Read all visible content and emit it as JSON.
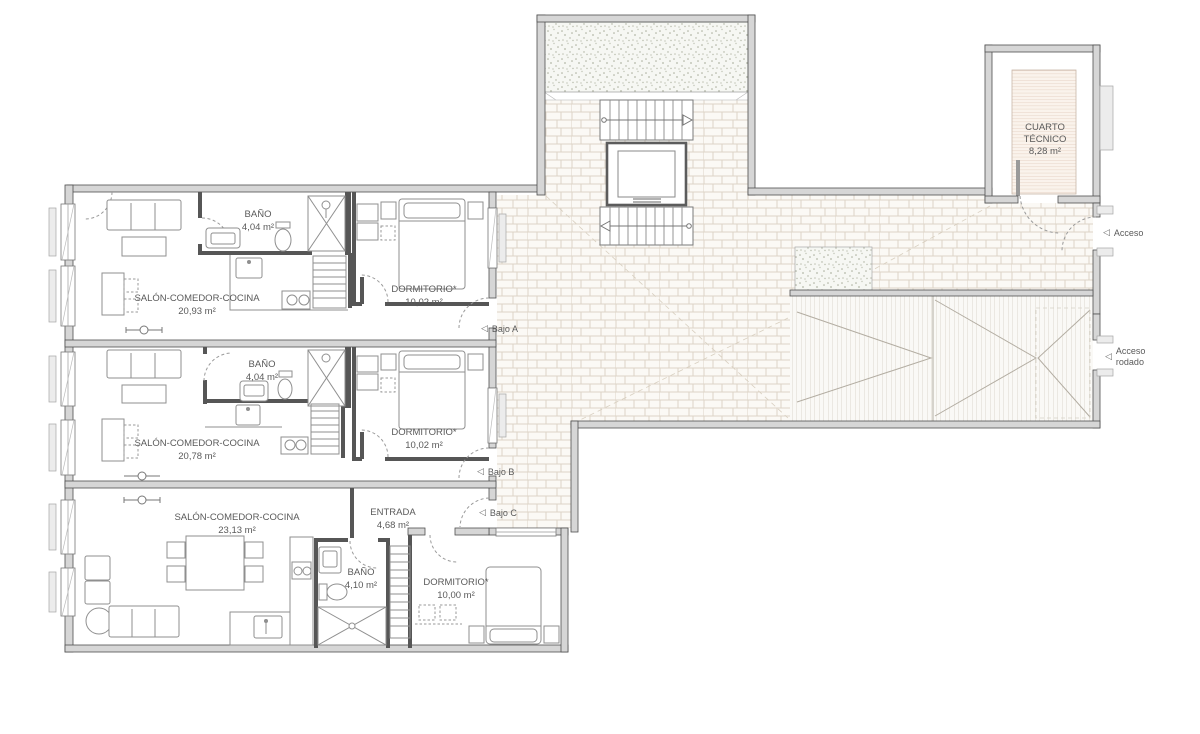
{
  "rooms": {
    "salon_a": {
      "name": "SALÓN-COMEDOR-COCINA",
      "area": "20,93 m²"
    },
    "bano_a": {
      "name": "BAÑO",
      "area": "4,04 m²"
    },
    "dorm_a": {
      "name": "DORMITORIO*",
      "area": "10,02 m²"
    },
    "salon_b": {
      "name": "SALÓN-COMEDOR-COCINA",
      "area": "20,78 m²"
    },
    "bano_b": {
      "name": "BAÑO",
      "area": "4,04 m²"
    },
    "dorm_b": {
      "name": "DORMITORIO*",
      "area": "10,02 m²"
    },
    "salon_c": {
      "name": "SALÓN-COMEDOR-COCINA",
      "area": "23,13 m²"
    },
    "entrada_c": {
      "name": "ENTRADA",
      "area": "4,68 m²"
    },
    "bano_c": {
      "name": "BAÑO",
      "area": "4,10 m²"
    },
    "dorm_c": {
      "name": "DORMITORIO*",
      "area": "10,00 m²"
    },
    "cuarto_tecnico": {
      "name_line1": "CUARTO",
      "name_line2": "TÉCNICO",
      "area": "8,28 m²"
    }
  },
  "annotations": {
    "bajo_a": "Bajo A",
    "bajo_b": "Bajo B",
    "bajo_c": "Bajo C",
    "acceso": "Acceso",
    "acceso_rodado_line1": "Acceso",
    "acceso_rodado_line2": "rodado"
  },
  "icons": {
    "direction_triangle": "◁"
  },
  "colors": {
    "wall_fill": "#d6d6d6",
    "wall_edge": "#4f4f4f",
    "partition": "#565656",
    "paving_joint": "#ddd4c7",
    "gravel_dot": "#a9ad9c",
    "label_text": "#5a5a5a",
    "door_arc": "#9a9a9a"
  }
}
